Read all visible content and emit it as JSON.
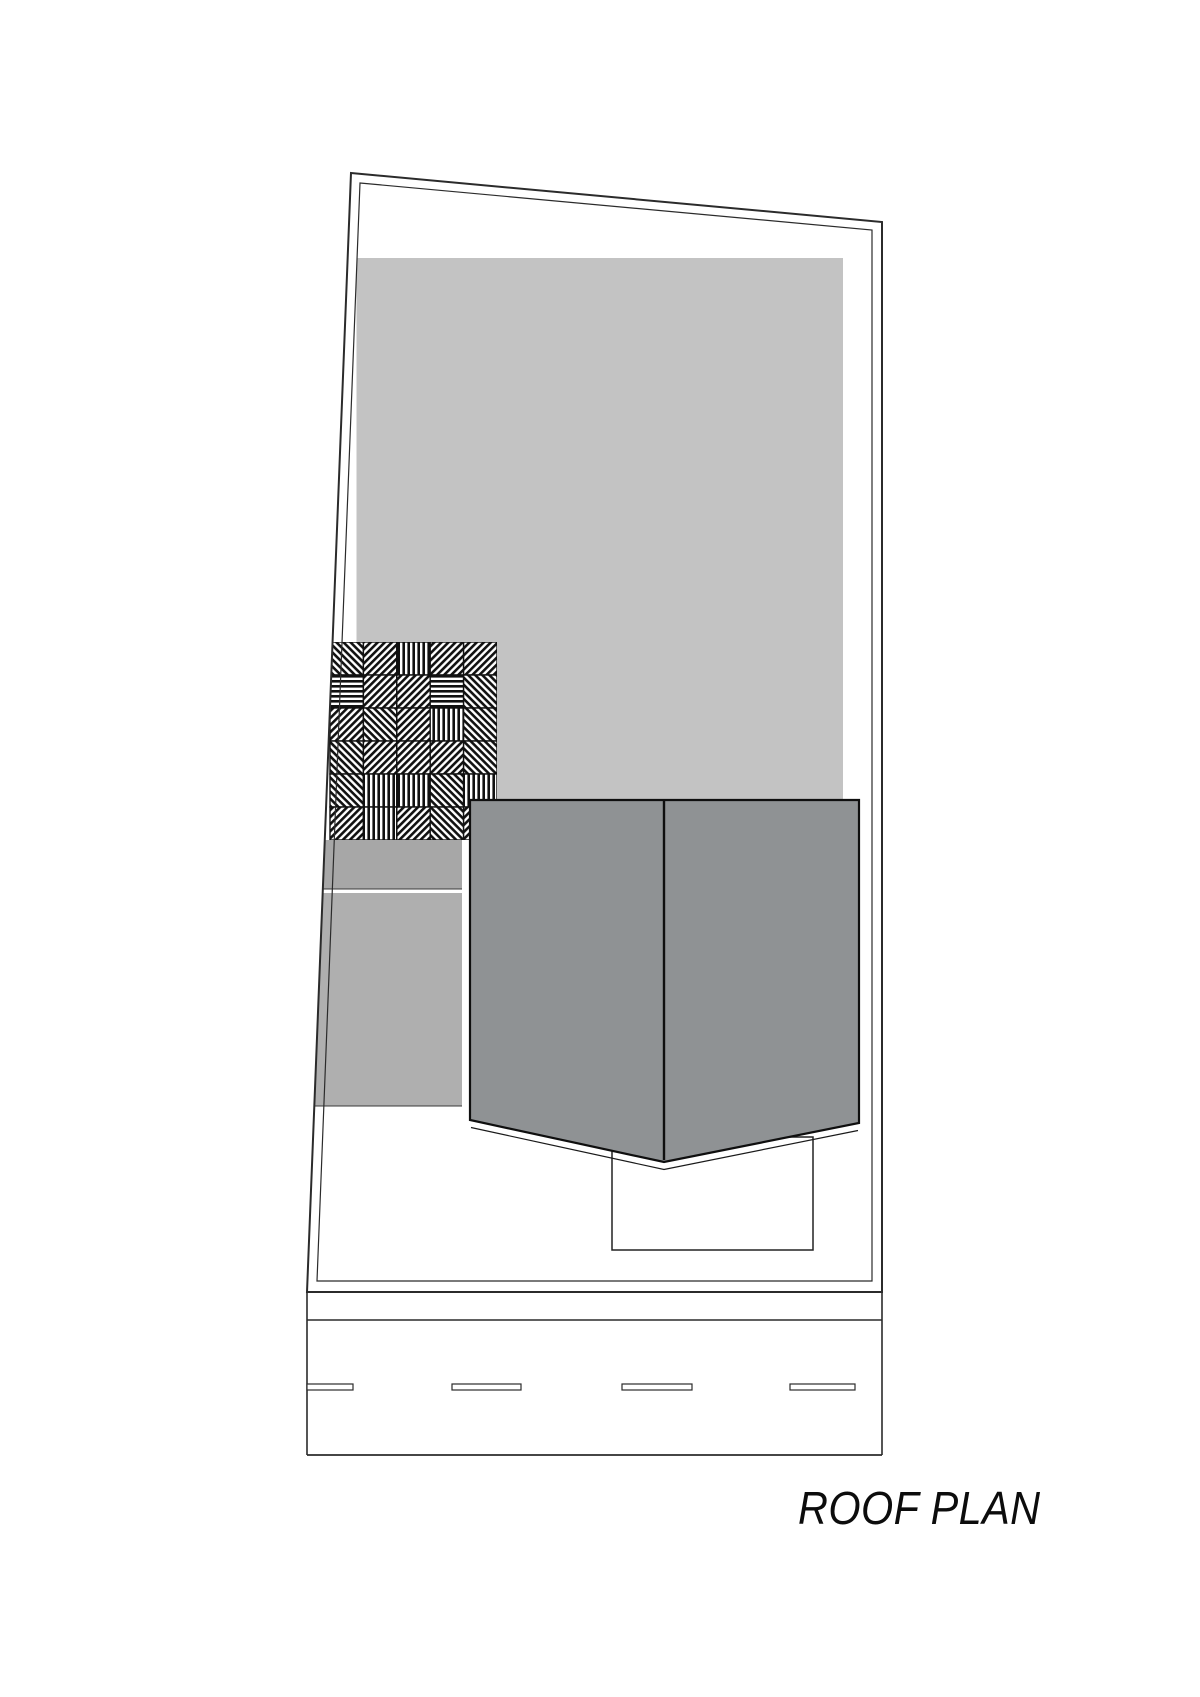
{
  "title": {
    "label": "ROOF PLAN"
  },
  "colors": {
    "paper": "#ffffff",
    "main_roof": "#c3c3c3",
    "terrace_upper": "#a7a7a7",
    "terrace_lower": "#afafaf",
    "hip_roof": "#8f9294",
    "line_dark": "#1a1a1a",
    "line_mid": "#3a3a3a"
  },
  "hatch": {
    "rows": [
      [
        "ne",
        "nw",
        "v",
        "nw",
        "nw"
      ],
      [
        "h",
        "nw",
        "nw",
        "h",
        "ne"
      ],
      [
        "nw",
        "ne",
        "nw",
        "v",
        "ne"
      ],
      [
        "ne",
        "nw",
        "nw",
        "nw",
        "ne"
      ],
      [
        "ne",
        "v",
        "v",
        "ne",
        "v"
      ],
      [
        "nw",
        "v",
        "nw",
        "ne",
        "nw"
      ]
    ]
  },
  "road": {
    "dash_y": 1384,
    "dash_h": 6,
    "dashes": [
      {
        "x": 307,
        "w": 46
      },
      {
        "x": 452,
        "w": 69
      },
      {
        "x": 622,
        "w": 70
      },
      {
        "x": 790,
        "w": 65
      }
    ]
  }
}
